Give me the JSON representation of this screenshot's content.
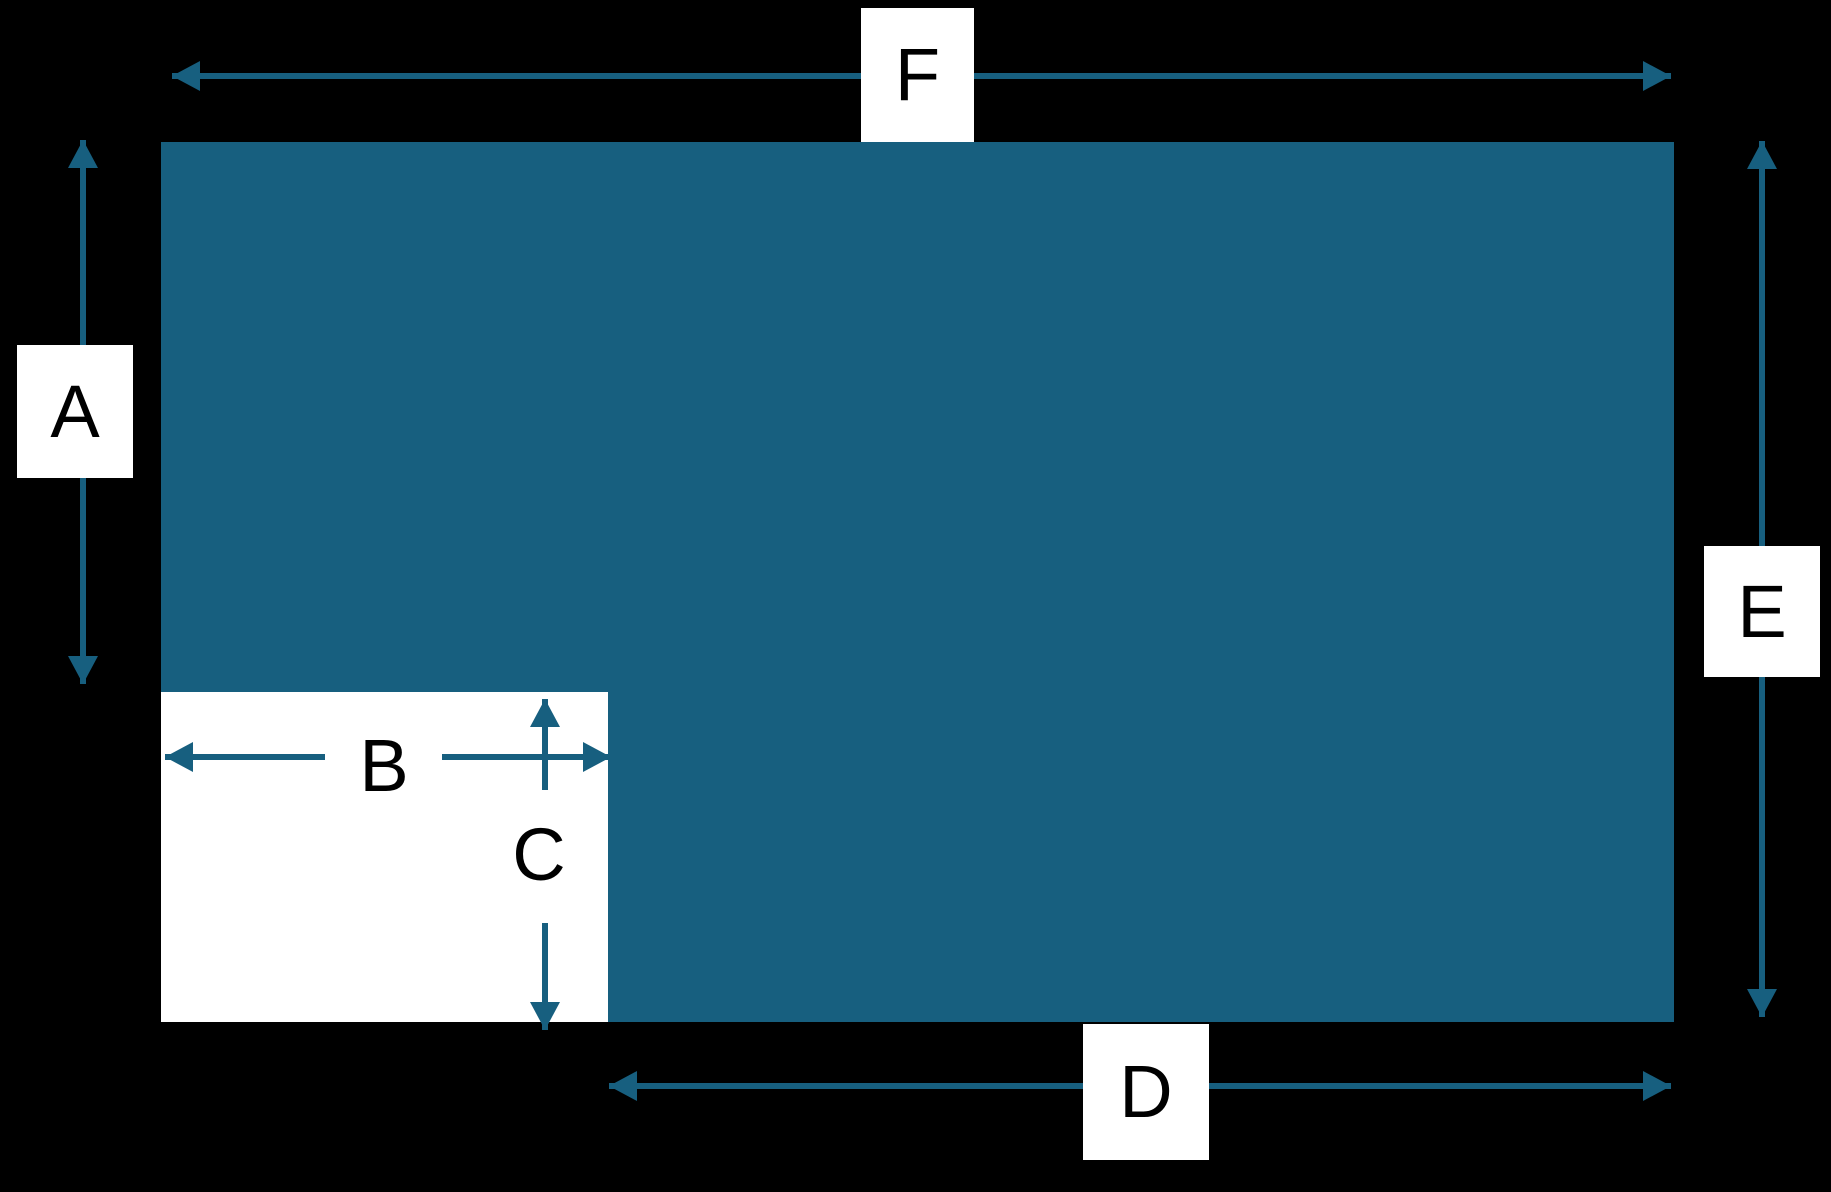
{
  "diagram": {
    "type": "geometry-dimension-diagram",
    "description": "Teal rectangle with a white rectangular cut-out at its bottom-left corner, annotated with double-headed dimension arrows",
    "colors": {
      "background": "#000000",
      "shape_fill": "#175F7F",
      "cutout_fill": "#FFFFFF",
      "arrow": "#175F7F",
      "label_box_background": "#FFFFFF",
      "label_text": "#000000"
    }
  },
  "labels": {
    "a": "A",
    "b": "B",
    "c": "C",
    "d": "D",
    "e": "E",
    "f": "F"
  }
}
